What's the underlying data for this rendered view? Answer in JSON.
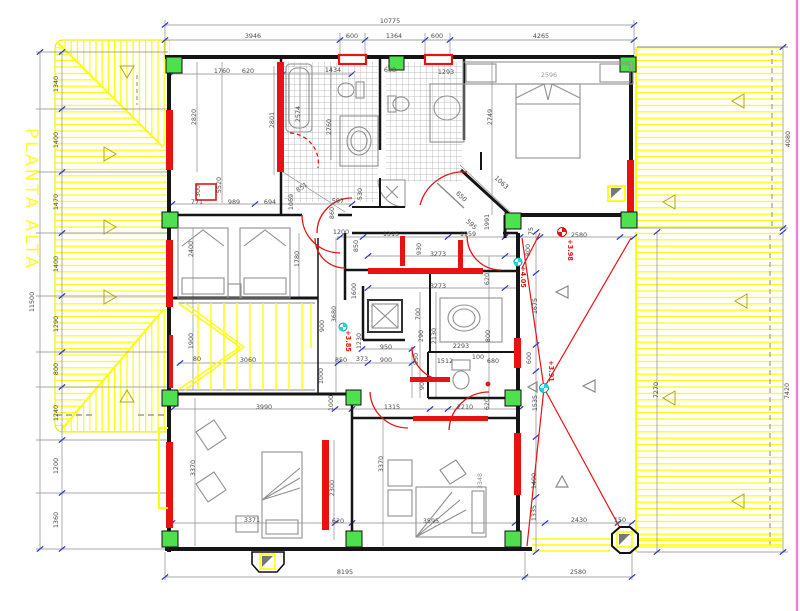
{
  "title": "PLANTA ALTA",
  "colors": {
    "red": "#e81212",
    "yellow": "#ffff00",
    "green": "#4ee04e",
    "blue": "#2d3cc4",
    "cyan": "#19d7e8",
    "magenta": "#f07fd0",
    "dimtext": "#4a4a4a",
    "wall": "#151515"
  },
  "dimensions": {
    "top": {
      "total": "10775",
      "segments": [
        "3946",
        "600",
        "1364",
        "600",
        "4265"
      ]
    },
    "left": {
      "total": "11500",
      "segments": [
        "1340",
        "1400",
        "1470",
        "1400",
        "1290",
        "800",
        "1240",
        "1200",
        "1360"
      ]
    },
    "bottom": {
      "segments": [
        "8195",
        "2580"
      ]
    },
    "right": {
      "roof_top": "4080",
      "roof_bottom": "7420",
      "terrace": "7270"
    }
  },
  "levels": [
    "+3.85",
    "+4.05",
    "+3.98",
    "+3.91"
  ],
  "labels": [
    {
      "t": "10775",
      "x": 390,
      "y": 23,
      "r": 0
    },
    {
      "t": "3946",
      "x": 253,
      "y": 38,
      "r": 0
    },
    {
      "t": "600",
      "x": 352,
      "y": 38,
      "r": 0
    },
    {
      "t": "1364",
      "x": 394,
      "y": 38,
      "r": 0
    },
    {
      "t": "600",
      "x": 437,
      "y": 38,
      "r": 0
    },
    {
      "t": "4265",
      "x": 541,
      "y": 38,
      "r": 0
    },
    {
      "t": "11500",
      "x": 34,
      "y": 302,
      "r": -90
    },
    {
      "t": "1340",
      "x": 58,
      "y": 84,
      "r": -90
    },
    {
      "t": "1400",
      "x": 58,
      "y": 140,
      "r": -90
    },
    {
      "t": "1470",
      "x": 58,
      "y": 202,
      "r": -90
    },
    {
      "t": "1400",
      "x": 58,
      "y": 264,
      "r": -90
    },
    {
      "t": "1290",
      "x": 58,
      "y": 324,
      "r": -90
    },
    {
      "t": "800",
      "x": 58,
      "y": 369,
      "r": -90
    },
    {
      "t": "1240",
      "x": 58,
      "y": 413,
      "r": -90
    },
    {
      "t": "1200",
      "x": 58,
      "y": 466,
      "r": -90
    },
    {
      "t": "1360",
      "x": 58,
      "y": 520,
      "r": -90
    },
    {
      "t": "8195",
      "x": 345,
      "y": 574,
      "r": 0
    },
    {
      "t": "2580",
      "x": 578,
      "y": 574,
      "r": 0
    },
    {
      "t": "4080",
      "x": 790,
      "y": 139,
      "r": -90
    },
    {
      "t": "7420",
      "x": 789,
      "y": 391,
      "r": -90
    },
    {
      "t": "7270",
      "x": 658,
      "y": 390,
      "r": -90
    },
    {
      "t": "1760",
      "x": 222,
      "y": 73,
      "r": 0
    },
    {
      "t": "620",
      "x": 248,
      "y": 73,
      "r": 0
    },
    {
      "t": "1434",
      "x": 333,
      "y": 72,
      "r": 0
    },
    {
      "t": "608",
      "x": 390,
      "y": 72,
      "r": 0
    },
    {
      "t": "1293",
      "x": 446,
      "y": 74,
      "r": 0
    },
    {
      "t": "2596",
      "x": 549,
      "y": 77,
      "r": 0,
      "c": "light"
    },
    {
      "t": "2820",
      "x": 196,
      "y": 117,
      "r": -90
    },
    {
      "t": "2801",
      "x": 274,
      "y": 120,
      "r": -90
    },
    {
      "t": "2574",
      "x": 300,
      "y": 114,
      "r": -90
    },
    {
      "t": "5520",
      "x": 221,
      "y": 185,
      "r": -90
    },
    {
      "t": "2760",
      "x": 331,
      "y": 127,
      "r": -90
    },
    {
      "t": "2749",
      "x": 492,
      "y": 117,
      "r": -90
    },
    {
      "t": "300",
      "x": 200,
      "y": 191,
      "r": -90
    },
    {
      "t": "771",
      "x": 197,
      "y": 204,
      "r": 0
    },
    {
      "t": "989",
      "x": 234,
      "y": 204,
      "r": 0
    },
    {
      "t": "694",
      "x": 270,
      "y": 204,
      "r": 0
    },
    {
      "t": "851",
      "x": 303,
      "y": 189,
      "r": -35
    },
    {
      "t": "1069",
      "x": 293,
      "y": 202,
      "r": -90
    },
    {
      "t": "597",
      "x": 338,
      "y": 203,
      "r": 0
    },
    {
      "t": "860",
      "x": 334,
      "y": 213,
      "r": -90
    },
    {
      "t": "530",
      "x": 362,
      "y": 194,
      "r": -90
    },
    {
      "t": "1063",
      "x": 500,
      "y": 184,
      "r": 42
    },
    {
      "t": "650",
      "x": 460,
      "y": 198,
      "r": 42
    },
    {
      "t": "595",
      "x": 470,
      "y": 226,
      "r": 42
    },
    {
      "t": "1991",
      "x": 489,
      "y": 222,
      "r": -90
    },
    {
      "t": "2400",
      "x": 193,
      "y": 249,
      "r": -90
    },
    {
      "t": "1780",
      "x": 299,
      "y": 259,
      "r": -90
    },
    {
      "t": "1200",
      "x": 341,
      "y": 234,
      "r": 0
    },
    {
      "t": "1315",
      "x": 391,
      "y": 236,
      "r": 0
    },
    {
      "t": "930",
      "x": 421,
      "y": 249,
      "r": -90
    },
    {
      "t": "1959",
      "x": 468,
      "y": 236,
      "r": 0
    },
    {
      "t": "75",
      "x": 533,
      "y": 231,
      "r": -90
    },
    {
      "t": "2580",
      "x": 579,
      "y": 237,
      "r": 0
    },
    {
      "t": "850",
      "x": 358,
      "y": 246,
      "r": -90
    },
    {
      "t": "800",
      "x": 530,
      "y": 250,
      "r": -90
    },
    {
      "t": "3273",
      "x": 438,
      "y": 256,
      "r": 0
    },
    {
      "t": "620",
      "x": 489,
      "y": 279,
      "r": -90
    },
    {
      "t": "3273",
      "x": 438,
      "y": 288,
      "r": 0
    },
    {
      "t": "1675",
      "x": 537,
      "y": 306,
      "r": -90
    },
    {
      "t": "3680",
      "x": 336,
      "y": 314,
      "r": -90
    },
    {
      "t": "900",
      "x": 324,
      "y": 326,
      "r": -90
    },
    {
      "t": "1600",
      "x": 356,
      "y": 291,
      "r": -90
    },
    {
      "t": "700",
      "x": 420,
      "y": 314,
      "r": -90
    },
    {
      "t": "290",
      "x": 423,
      "y": 336,
      "r": -90
    },
    {
      "t": "2130",
      "x": 436,
      "y": 336,
      "r": -90
    },
    {
      "t": "1230",
      "x": 361,
      "y": 341,
      "r": -90
    },
    {
      "t": "950",
      "x": 386,
      "y": 349,
      "r": 0
    },
    {
      "t": "373",
      "x": 362,
      "y": 361,
      "r": 0
    },
    {
      "t": "900",
      "x": 386,
      "y": 362,
      "r": 0
    },
    {
      "t": "850",
      "x": 341,
      "y": 362,
      "r": 0
    },
    {
      "t": "3060",
      "x": 248,
      "y": 362,
      "r": 0
    },
    {
      "t": "80",
      "x": 197,
      "y": 361,
      "r": 0
    },
    {
      "t": "1900",
      "x": 193,
      "y": 341,
      "r": -90
    },
    {
      "t": "1000",
      "x": 323,
      "y": 376,
      "r": -90
    },
    {
      "t": "2293",
      "x": 461,
      "y": 348,
      "r": 0
    },
    {
      "t": "1512",
      "x": 445,
      "y": 363,
      "r": 0
    },
    {
      "t": "100",
      "x": 478,
      "y": 359,
      "r": 0
    },
    {
      "t": "680",
      "x": 493,
      "y": 363,
      "r": 0
    },
    {
      "t": "850",
      "x": 418,
      "y": 359,
      "r": -90
    },
    {
      "t": "90",
      "x": 424,
      "y": 386,
      "r": -90
    },
    {
      "t": "800",
      "x": 490,
      "y": 336,
      "r": -90
    },
    {
      "t": "600",
      "x": 531,
      "y": 358,
      "r": -90
    },
    {
      "t": "1535",
      "x": 537,
      "y": 403,
      "r": -90
    },
    {
      "t": "1000",
      "x": 333,
      "y": 403,
      "r": -90
    },
    {
      "t": "3990",
      "x": 264,
      "y": 409,
      "r": 0
    },
    {
      "t": "1315",
      "x": 392,
      "y": 409,
      "r": 0
    },
    {
      "t": "2210",
      "x": 465,
      "y": 409,
      "r": 0
    },
    {
      "t": "620",
      "x": 489,
      "y": 404,
      "r": -90
    },
    {
      "t": "3370",
      "x": 195,
      "y": 468,
      "r": -90
    },
    {
      "t": "3370",
      "x": 383,
      "y": 464,
      "r": -90
    },
    {
      "t": "2300",
      "x": 334,
      "y": 488,
      "r": -90
    },
    {
      "t": "620",
      "x": 338,
      "y": 523,
      "r": 0
    },
    {
      "t": "3371",
      "x": 252,
      "y": 522,
      "r": 0
    },
    {
      "t": "3595",
      "x": 431,
      "y": 523,
      "r": 0
    },
    {
      "t": "3348",
      "x": 482,
      "y": 481,
      "r": -90,
      "c": "light"
    },
    {
      "t": "1400",
      "x": 536,
      "y": 481,
      "r": -90
    },
    {
      "t": "1335",
      "x": 536,
      "y": 513,
      "r": -90
    },
    {
      "t": "2430",
      "x": 579,
      "y": 522,
      "r": 0
    },
    {
      "t": "150",
      "x": 620,
      "y": 522,
      "r": 0
    },
    {
      "t": "+3.85",
      "x": 346,
      "y": 341,
      "r": 90,
      "c": "red"
    },
    {
      "t": "+4.05",
      "x": 521,
      "y": 277,
      "r": 90,
      "c": "red"
    },
    {
      "t": "+3.98",
      "x": 568,
      "y": 250,
      "r": 90,
      "c": "red"
    },
    {
      "t": "+3.91",
      "x": 549,
      "y": 371,
      "r": 90,
      "c": "red"
    }
  ]
}
